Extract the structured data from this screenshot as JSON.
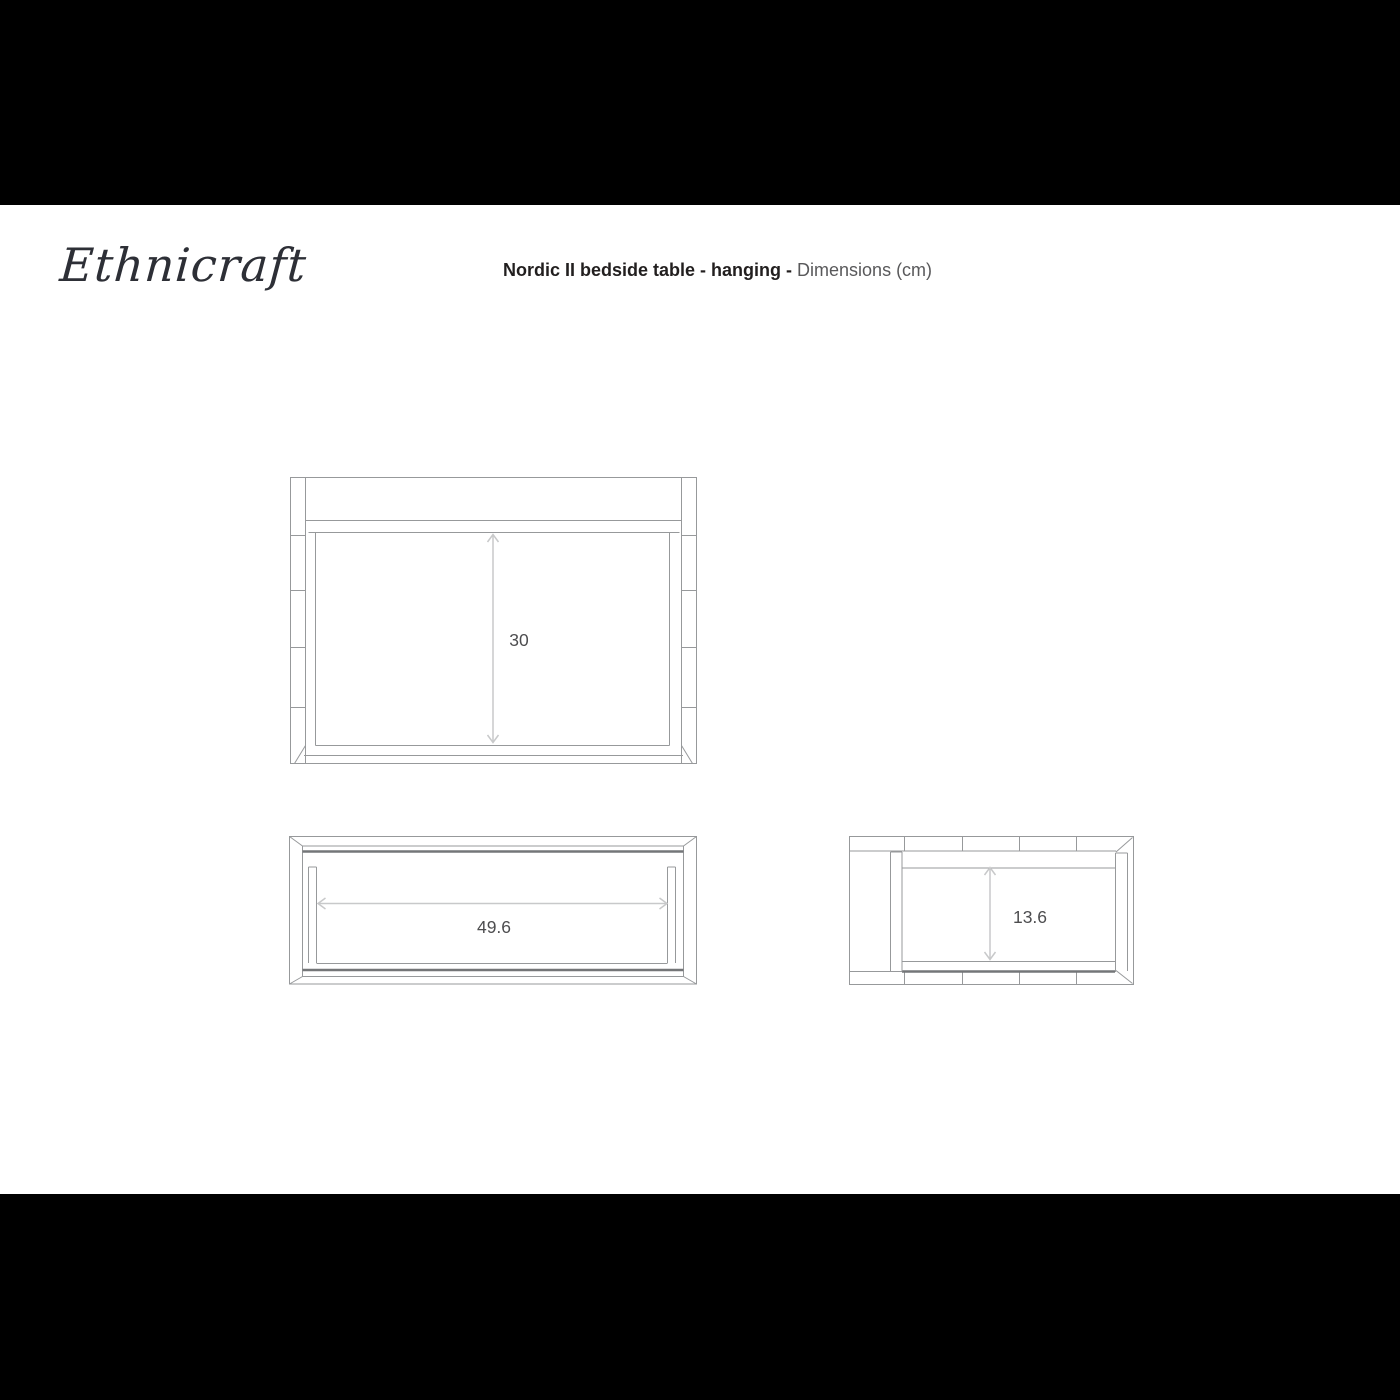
{
  "header": {
    "logo": "Ethnicraft",
    "title": {
      "product": "Nordic II bedside table - hanging - ",
      "suffix": "Dimensions (cm)"
    }
  },
  "diagram": {
    "views": {
      "front": {
        "dimension": "30"
      },
      "top": {
        "dimension": "49.6"
      },
      "side": {
        "dimension": "13.6"
      }
    }
  },
  "colors": {
    "background": "#ffffff",
    "letterbox": "#000000",
    "line": "#97999b",
    "line_dark": "#747678",
    "dimension_line": "#c8c9ca",
    "dimension_text": "#4d4d4f",
    "title_text": "#221f1f",
    "title_muted": "#59595b",
    "logo_text": "#2d2f36"
  }
}
